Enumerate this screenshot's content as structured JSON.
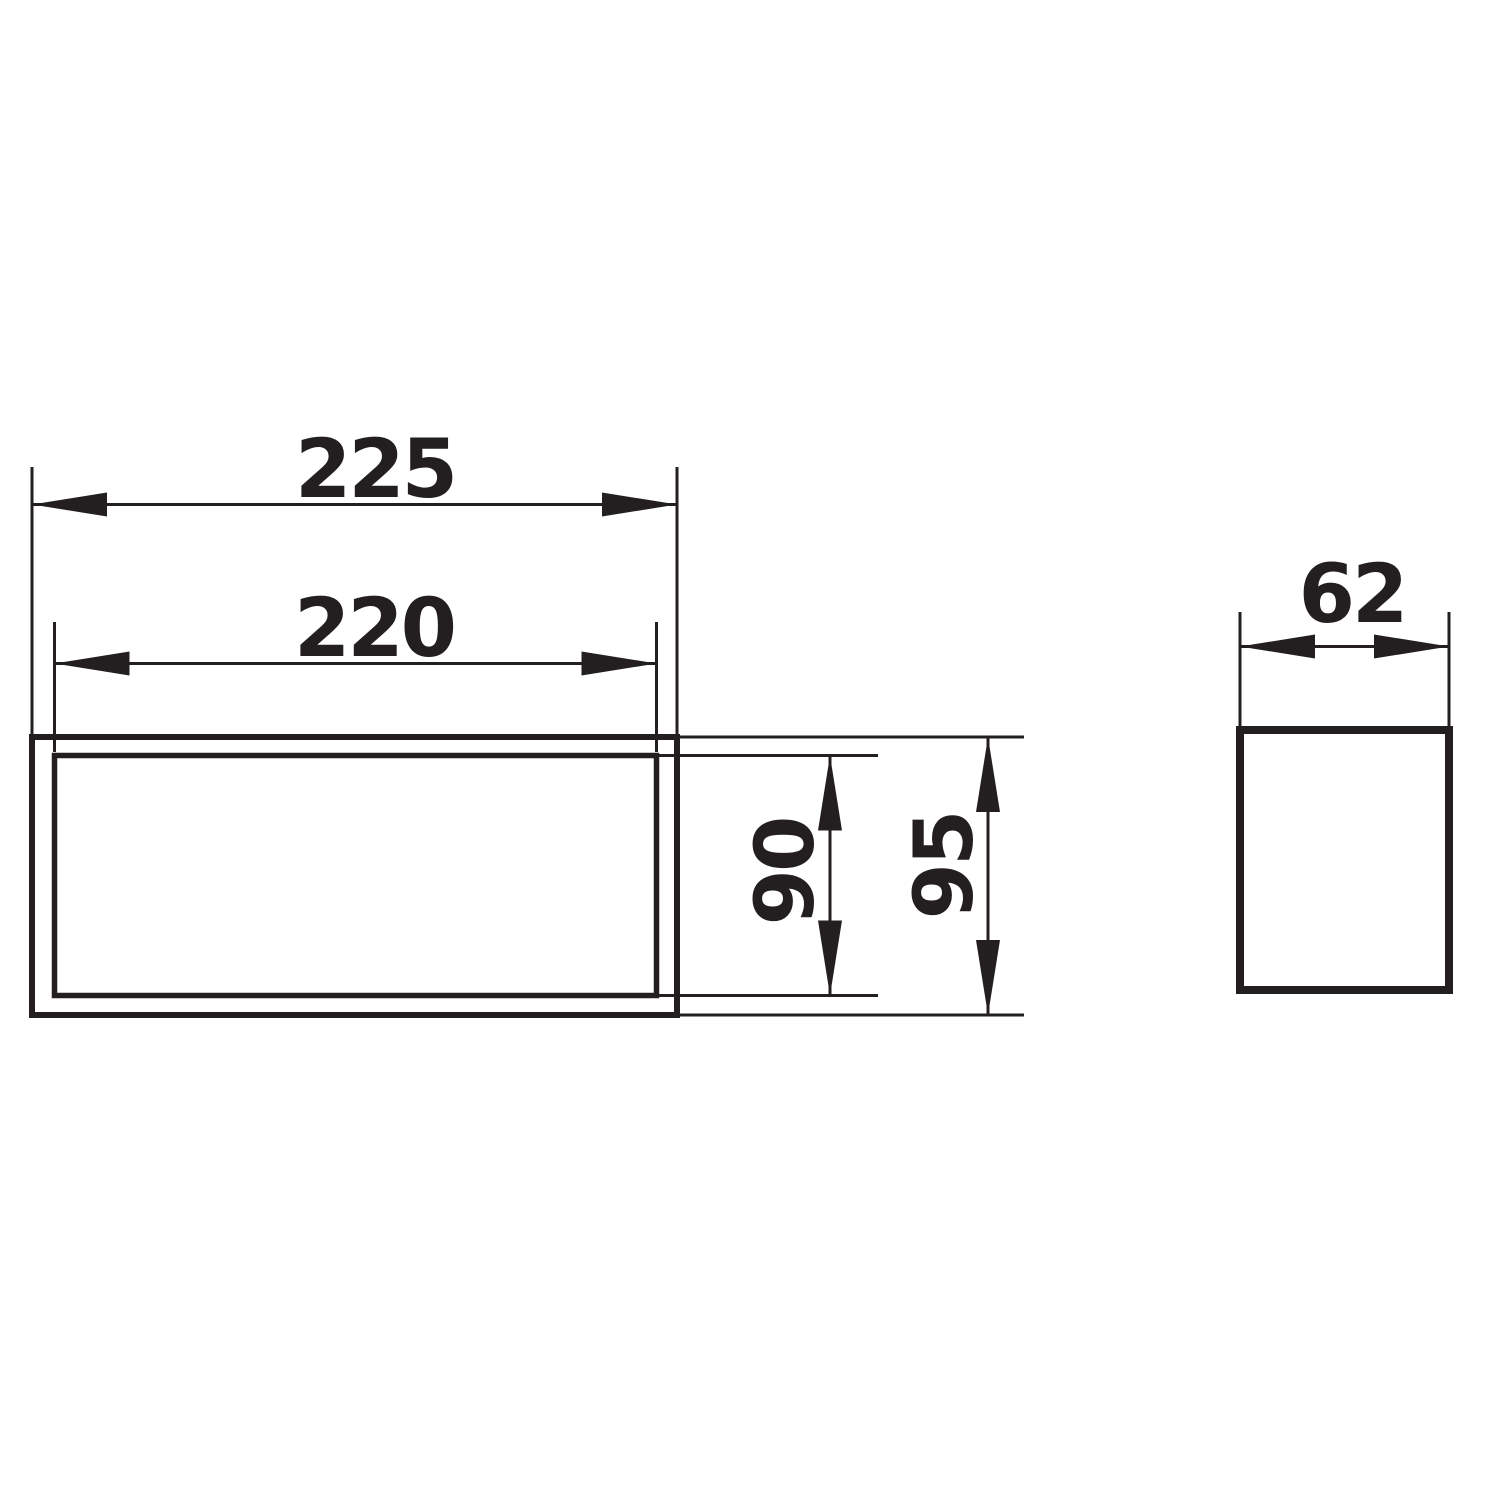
{
  "drawing": {
    "background_color": "#ffffff",
    "line_color": "#231f20",
    "dimensions": {
      "outer_width": "225",
      "inner_width": "220",
      "inner_height": "90",
      "outer_height": "95",
      "depth": "62"
    }
  }
}
